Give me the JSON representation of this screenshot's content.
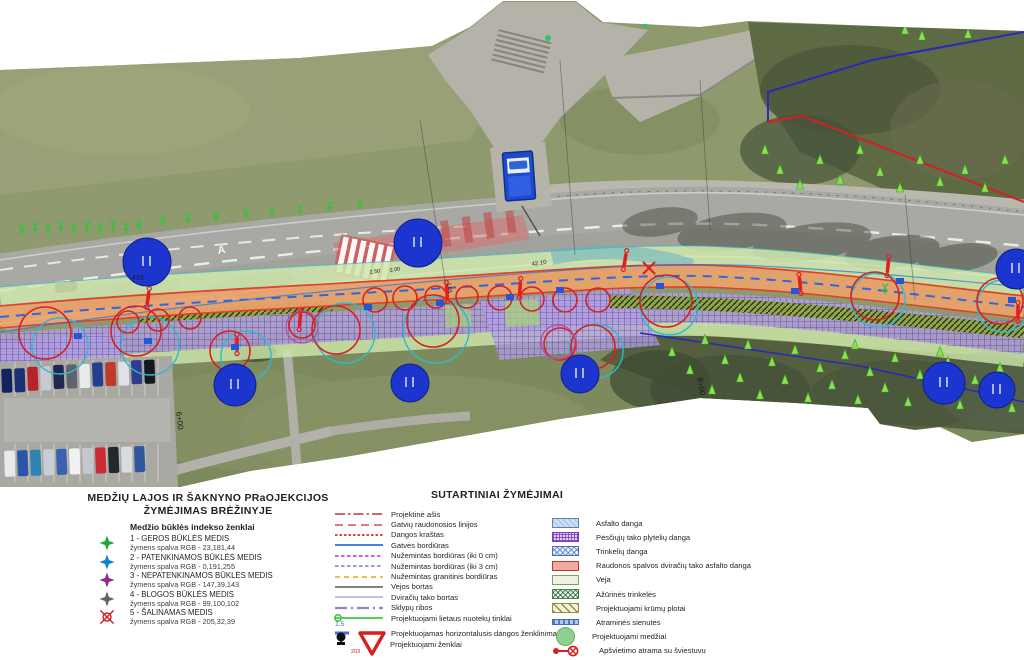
{
  "tree_legend": {
    "title_line1": "MEDŽIŲ LAJOS IR ŠAKNYNO PRaOJEKCIJOS",
    "title_line2": "ŽYMĖJIMAS BRĖŽINYJE",
    "subtitle": "Medžio būklės indekso ženklai",
    "items": [
      {
        "symbol": "star",
        "color": "#1fa83c",
        "label": "1 - GEROS BŪKLĖS MEDIS",
        "sub": "žymens spalva RGB - 23,181,44"
      },
      {
        "symbol": "star",
        "color": "#0f7fd0",
        "label": "2 - PATENKINAMOS BŪKLĖS MEDIS",
        "sub": "žymens spalva RGB -  0,191,255"
      },
      {
        "symbol": "star",
        "color": "#93278f",
        "label": "3 - NEPATENKINAMOS BŪKLĖS MEDIS",
        "sub": "žymens spalva RGB -  147,39,143"
      },
      {
        "symbol": "star",
        "color": "#636466",
        "label": "4 - BLOGOS BŪKLĖS MEDIS",
        "sub": "žymens spalva RGB - 99,100,102"
      },
      {
        "symbol": "removal",
        "color": "#cd2027",
        "label": "5 - ŠALINAMAS MEDIS",
        "sub": "žymens spalva RGB - 205,32,39"
      }
    ]
  },
  "symbols_legend": {
    "heading": "SUTARTINIAI ŽYMĖJIMAI",
    "lines": [
      {
        "label": "Projektinė ašis",
        "color": "#b03a3a",
        "dash": "10 3 2.5 3",
        "width": "1.6"
      },
      {
        "label": "Gatvių raudonosios linijos",
        "color": "#e04848",
        "dash": "8 5",
        "width": "1.6"
      },
      {
        "label": "Dangos kraštas",
        "color": "#d24848",
        "dash": "2.5 2",
        "width": "2"
      },
      {
        "label": "Gatvės bordiūras",
        "color": "#2e6fd6",
        "width": "1.8"
      },
      {
        "label": "Nužemintas bordiūras (iki 0 cm)",
        "color": "#c44fd0",
        "dash": "3.5 2.5",
        "width": "1.8"
      },
      {
        "label": "Nužemintas bordiūras (iki 3 cm)",
        "color": "#7f92cf",
        "dash": "3.5 2.5",
        "width": "1.8"
      },
      {
        "label": "Nužemintas granitinis bordiūras",
        "color": "#e9b23e",
        "dash": "5 4",
        "width": "1.8"
      },
      {
        "label": "Vejos bortas",
        "color": "#555759",
        "width": "1.6"
      },
      {
        "label": "Dviračių tako bortas",
        "color": "#b8b2e6",
        "width": "1.8"
      },
      {
        "label": "Sklypų ribos",
        "color": "#8a84da",
        "dash": "12 4 2 4",
        "width": "2.2"
      },
      {
        "label": "Projektuojami lietaus nuotekų tinklai",
        "color": "#3ecb3e",
        "width": "1.8",
        "marker": "circle",
        "sublabel": "1.5"
      },
      {
        "label": "Projektuojamas horizontalusis dangos ženklinimas",
        "color": "#3a6fd8",
        "dash": "14 10",
        "width": "3",
        "gap": "gap"
      }
    ],
    "signs_label": "Projektuojami ženklai",
    "sign_number": "203"
  },
  "surfaces_legend": {
    "items": [
      {
        "label": "Asfalto danga",
        "pattern": "asphalt"
      },
      {
        "label": "Pėsčiųjų tako plytelių danga",
        "pattern": "tiles"
      },
      {
        "label": "Trinkelių danga",
        "pattern": "pavers"
      },
      {
        "label": "Raudonos spalvos dviračių tako asfalto danga",
        "pattern": "solid",
        "fill": "#f2a9a1",
        "border": "#c0392b"
      },
      {
        "label": "Veja",
        "pattern": "solid",
        "fill": "#eef3e0",
        "border": "#8a9a6a"
      },
      {
        "label": "Ažūrinės trinkelės",
        "pattern": "openwork"
      },
      {
        "label": "Projektuojami krūmų plotai",
        "pattern": "shrubs"
      },
      {
        "label": "Atraminės sienutės",
        "pattern": "wall"
      },
      {
        "label": "Projektuojami medžiai",
        "pattern": "circleswatch",
        "fill": "#8fd08f"
      },
      {
        "label": "Apšvietimo atrama su šviestuvu",
        "pattern": "lamp",
        "fill": "#d42020"
      }
    ]
  },
  "map_labels": {
    "tree_number": "415",
    "station_1": "6+00",
    "station_2": "8+00",
    "dim_1": "42.10",
    "dim_2": "2.50",
    "dim_3": "2.00",
    "dim_4": "1.65",
    "lane_letter": "A"
  },
  "colors": {
    "bike_path": "#eca36b",
    "pedestrian_grid": "#b3a0e2",
    "veja_strip": "#cfe8ad",
    "tree_marker_blue": "#1c35cf",
    "crown_red": "#d42222",
    "crown_cyan": "#31b8cf",
    "boundary_navy": "#2a2ab8",
    "boundary_red": "#d42020"
  }
}
